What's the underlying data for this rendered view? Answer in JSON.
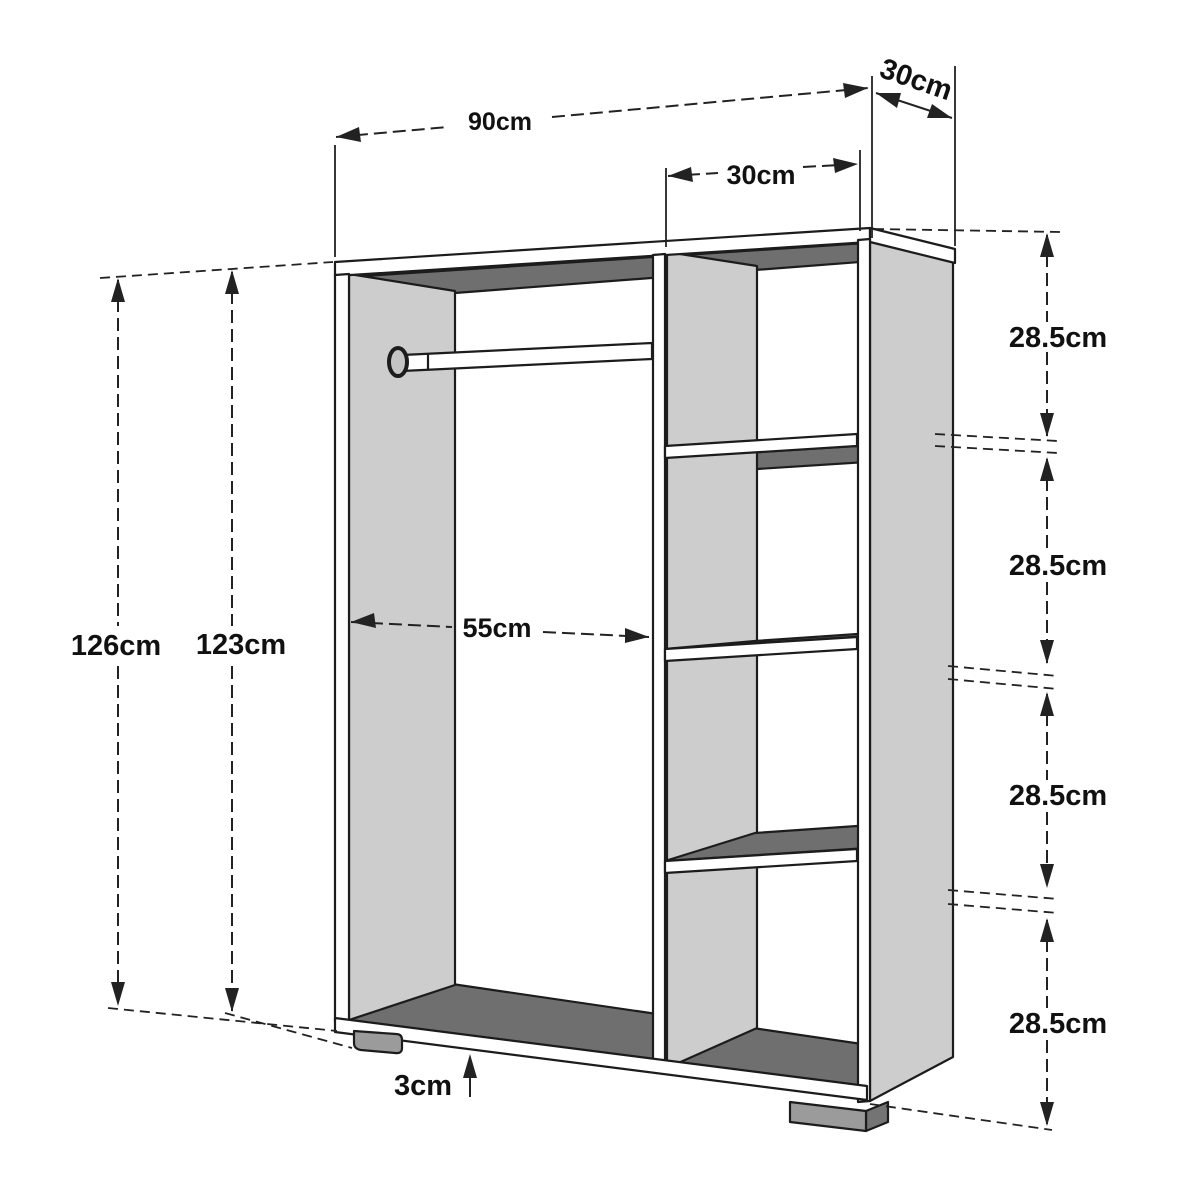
{
  "diagram": {
    "title": "open-wardrobe-shelf-unit-dimension-drawing",
    "unit": "cm",
    "dimensions": {
      "width_total": "90cm",
      "depth_top": "30cm",
      "shelf_column_width": "30cm",
      "height_total": "126cm",
      "height_body": "123cm",
      "hanging_section_width": "55cm",
      "foot_height": "3cm",
      "shelf_spacing_1": "28.5cm",
      "shelf_spacing_2": "28.5cm",
      "shelf_spacing_3": "28.5cm",
      "shelf_spacing_4": "28.5cm"
    },
    "colors": {
      "background": "#ffffff",
      "panel_face_light": "#cdcdcd",
      "panel_face_dark": "#6f6f6f",
      "foot_front": "#9b9b9b",
      "foot_side": "#747474",
      "outline": "#1c1c1c",
      "dimension_line": "#222222",
      "text": "#111111"
    }
  }
}
